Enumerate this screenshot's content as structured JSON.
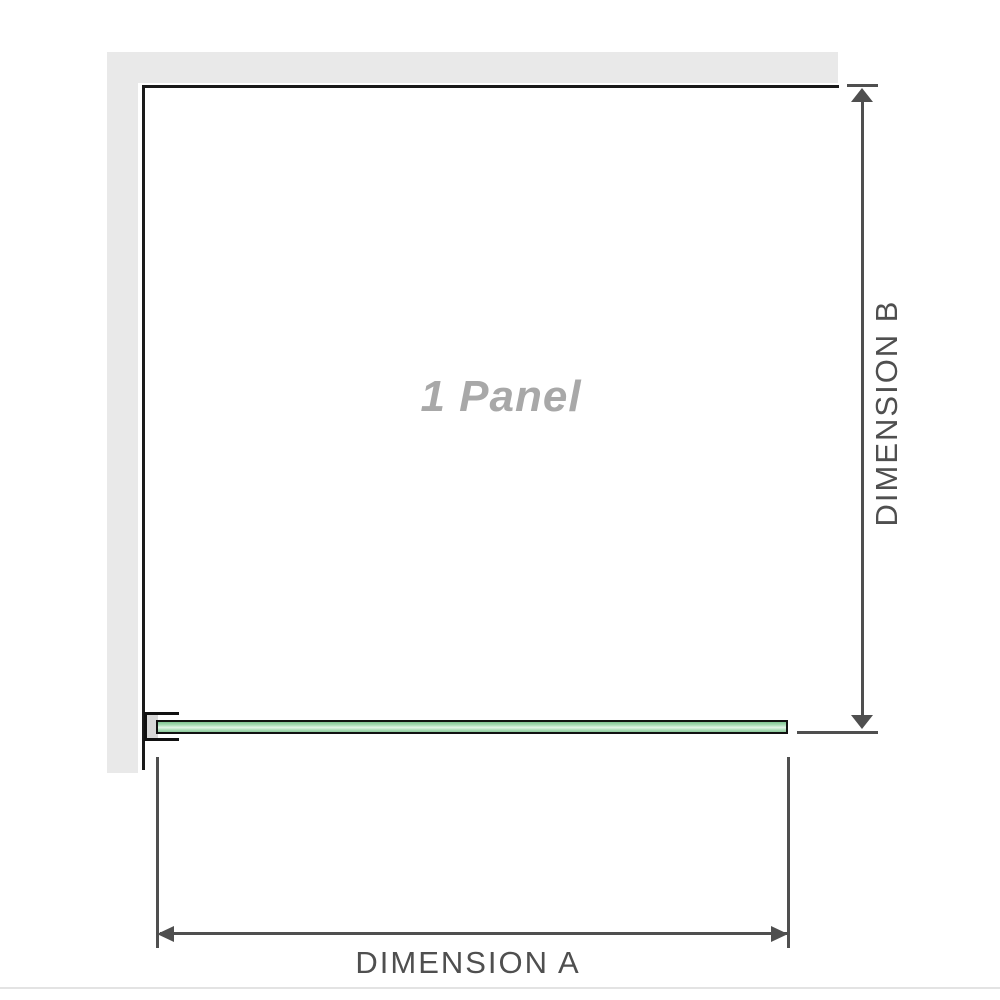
{
  "diagram": {
    "panel_label": "1 Panel",
    "dimensions": {
      "a_label": "DIMENSION A",
      "b_label": "DIMENSION B"
    },
    "colors": {
      "wall_gray": "#e9e9e9",
      "outline_black": "#1a1a1a",
      "dimension_gray": "#4f4f4f",
      "glass_green": "#8fd09e",
      "glass_highlight": "#e3f4e8",
      "bracket_gray": "#d8d8d8",
      "panel_label_gray": "#a8a8a8",
      "divider_gray": "#e3e3e3"
    }
  }
}
